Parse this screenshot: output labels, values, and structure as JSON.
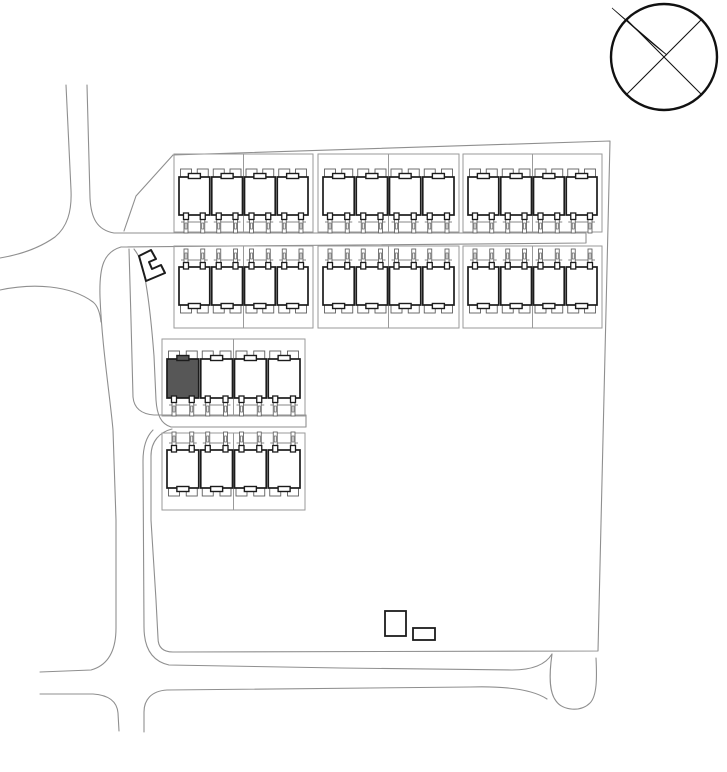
{
  "canvas": {
    "width": 727,
    "height": 772,
    "background": "#ffffff"
  },
  "colors": {
    "bold_outline": "#1c1c1c",
    "thin_detail": "#5f5f5f",
    "parcel_line": "#9a9a9a",
    "road_line": "#8f8f8f",
    "boundary_line": "#8f8f8f",
    "highlight_fill": "#575757",
    "building_fill": "#ffffff",
    "compass_ink": "#111111"
  },
  "compass": {
    "cx": 664,
    "cy": 57,
    "r": 53,
    "ring_stroke": 2.4,
    "cross_stroke": 1.1,
    "cross_lines": [
      [
        626.5,
        19.5,
        701.5,
        94.5
      ],
      [
        626.5,
        94.5,
        701.5,
        19.5
      ]
    ],
    "needle_path": "M612,8 L667,55 C651,43 632,26 612,8 Z"
  },
  "boundary": [
    {
      "name": "site-boundary-main",
      "d": "M173,155 L610,141 L598,651 L173,652 C163,652 158,647 158,638 L156,600 L151,520 L151,456 C151,441 160,432 172,429"
    },
    {
      "name": "site-boundary-northwest",
      "d": "M173,155 L136,196 L124,231"
    }
  ],
  "roads": [
    {
      "name": "north-road-left-edge",
      "d": "M66,85 L71,190 C72,212 67,227 55,237 C38,249 18,255 0,258"
    },
    {
      "name": "north-road-right-edge-central-road-top",
      "d": "M87,85 L90,198 C91,218 97,230 114,233 L586,233"
    },
    {
      "name": "southwest-branch-road",
      "d": "M0,290 C33,283 70,285 93,302 C98,306 100,313 101,322"
    },
    {
      "name": "west-lane-left-edge",
      "d": "M121,247 C104,252 99,266 100,297 C102,347 110,396 113,430 L116,520 L116,628 C116,649 109,665 91,670 L40,672"
    },
    {
      "name": "central-road-bottom-edge",
      "d": "M121,247 L586,243 L586,233"
    },
    {
      "name": "west-lane-right-edge-upper",
      "d": "M129,249 L131,320 L133,397 C134,408 141,414 154,415 L306,415 L306,427"
    },
    {
      "name": "lane-edge-past-utility-building",
      "d": "M134,249 C141,258 144,268 146,284 C150,308 152,330 154,356 L156,400 C157,415 161,424 171,427 L306,427"
    },
    {
      "name": "west-lane-right-edge-lower",
      "d": "M153,430 C146,437 143,447 143,461 L144,627 C144,647 151,661 169,665 L340,668 L512,670 C534,670 546,664 552,654"
    },
    {
      "name": "turning-head",
      "d": "M552,654 C549,675 549,692 556,701 C563,711 581,712 590,703 C597,696 597,678 596,658"
    },
    {
      "name": "south-road-bottom-edge-west",
      "d": "M40,694 L93,694 C108,695 117,701 118,713 L119,731"
    },
    {
      "name": "south-road-bottom-edge-east",
      "d": "M144,732 L144,712 C144,700 151,691 167,690 L470,687 C505,686 532,689 547,699"
    }
  ],
  "blocks": [
    {
      "name": "block-north-row-left",
      "parcel": {
        "x": 174,
        "y": 154,
        "w": 139,
        "h": 78
      },
      "facing": "down",
      "body_y": 177,
      "body_h": 38,
      "units": 4,
      "highlight": -1
    },
    {
      "name": "block-north-row-middle",
      "parcel": {
        "x": 318,
        "y": 154,
        "w": 141,
        "h": 78
      },
      "facing": "down",
      "body_y": 177,
      "body_h": 38,
      "units": 4,
      "highlight": -1
    },
    {
      "name": "block-north-row-right",
      "parcel": {
        "x": 463,
        "y": 154,
        "w": 139,
        "h": 78
      },
      "facing": "down",
      "body_y": 177,
      "body_h": 38,
      "units": 4,
      "highlight": -1
    },
    {
      "name": "block-second-row-left",
      "parcel": {
        "x": 174,
        "y": 246,
        "w": 139,
        "h": 82
      },
      "facing": "up",
      "body_y": 267,
      "body_h": 38,
      "units": 4,
      "highlight": -1
    },
    {
      "name": "block-second-row-middle",
      "parcel": {
        "x": 318,
        "y": 246,
        "w": 141,
        "h": 82
      },
      "facing": "up",
      "body_y": 267,
      "body_h": 38,
      "units": 4,
      "highlight": -1
    },
    {
      "name": "block-second-row-right",
      "parcel": {
        "x": 463,
        "y": 246,
        "w": 139,
        "h": 82
      },
      "facing": "up",
      "body_y": 267,
      "body_h": 38,
      "units": 4,
      "highlight": -1
    },
    {
      "name": "block-west-row-upper",
      "parcel": {
        "x": 162,
        "y": 339,
        "w": 143,
        "h": 77
      },
      "facing": "down",
      "body_y": 359,
      "body_h": 39,
      "units": 4,
      "highlight": 0
    },
    {
      "name": "block-west-row-lower",
      "parcel": {
        "x": 162,
        "y": 433,
        "w": 143,
        "h": 77
      },
      "facing": "up",
      "body_y": 450,
      "body_h": 38,
      "units": 4,
      "highlight": -1
    }
  ],
  "structures": {
    "utility_building": {
      "name": "utility-building",
      "d": "M139,256 L151,250 L156,259 L149,262 L152,269 L161,265 L165,273 L146,281 Z"
    },
    "outbuildings": [
      {
        "name": "outbuilding-large",
        "x": 385,
        "y": 611,
        "w": 21,
        "h": 25
      },
      {
        "name": "outbuilding-small",
        "x": 413,
        "y": 628,
        "w": 22,
        "h": 12
      }
    ]
  }
}
